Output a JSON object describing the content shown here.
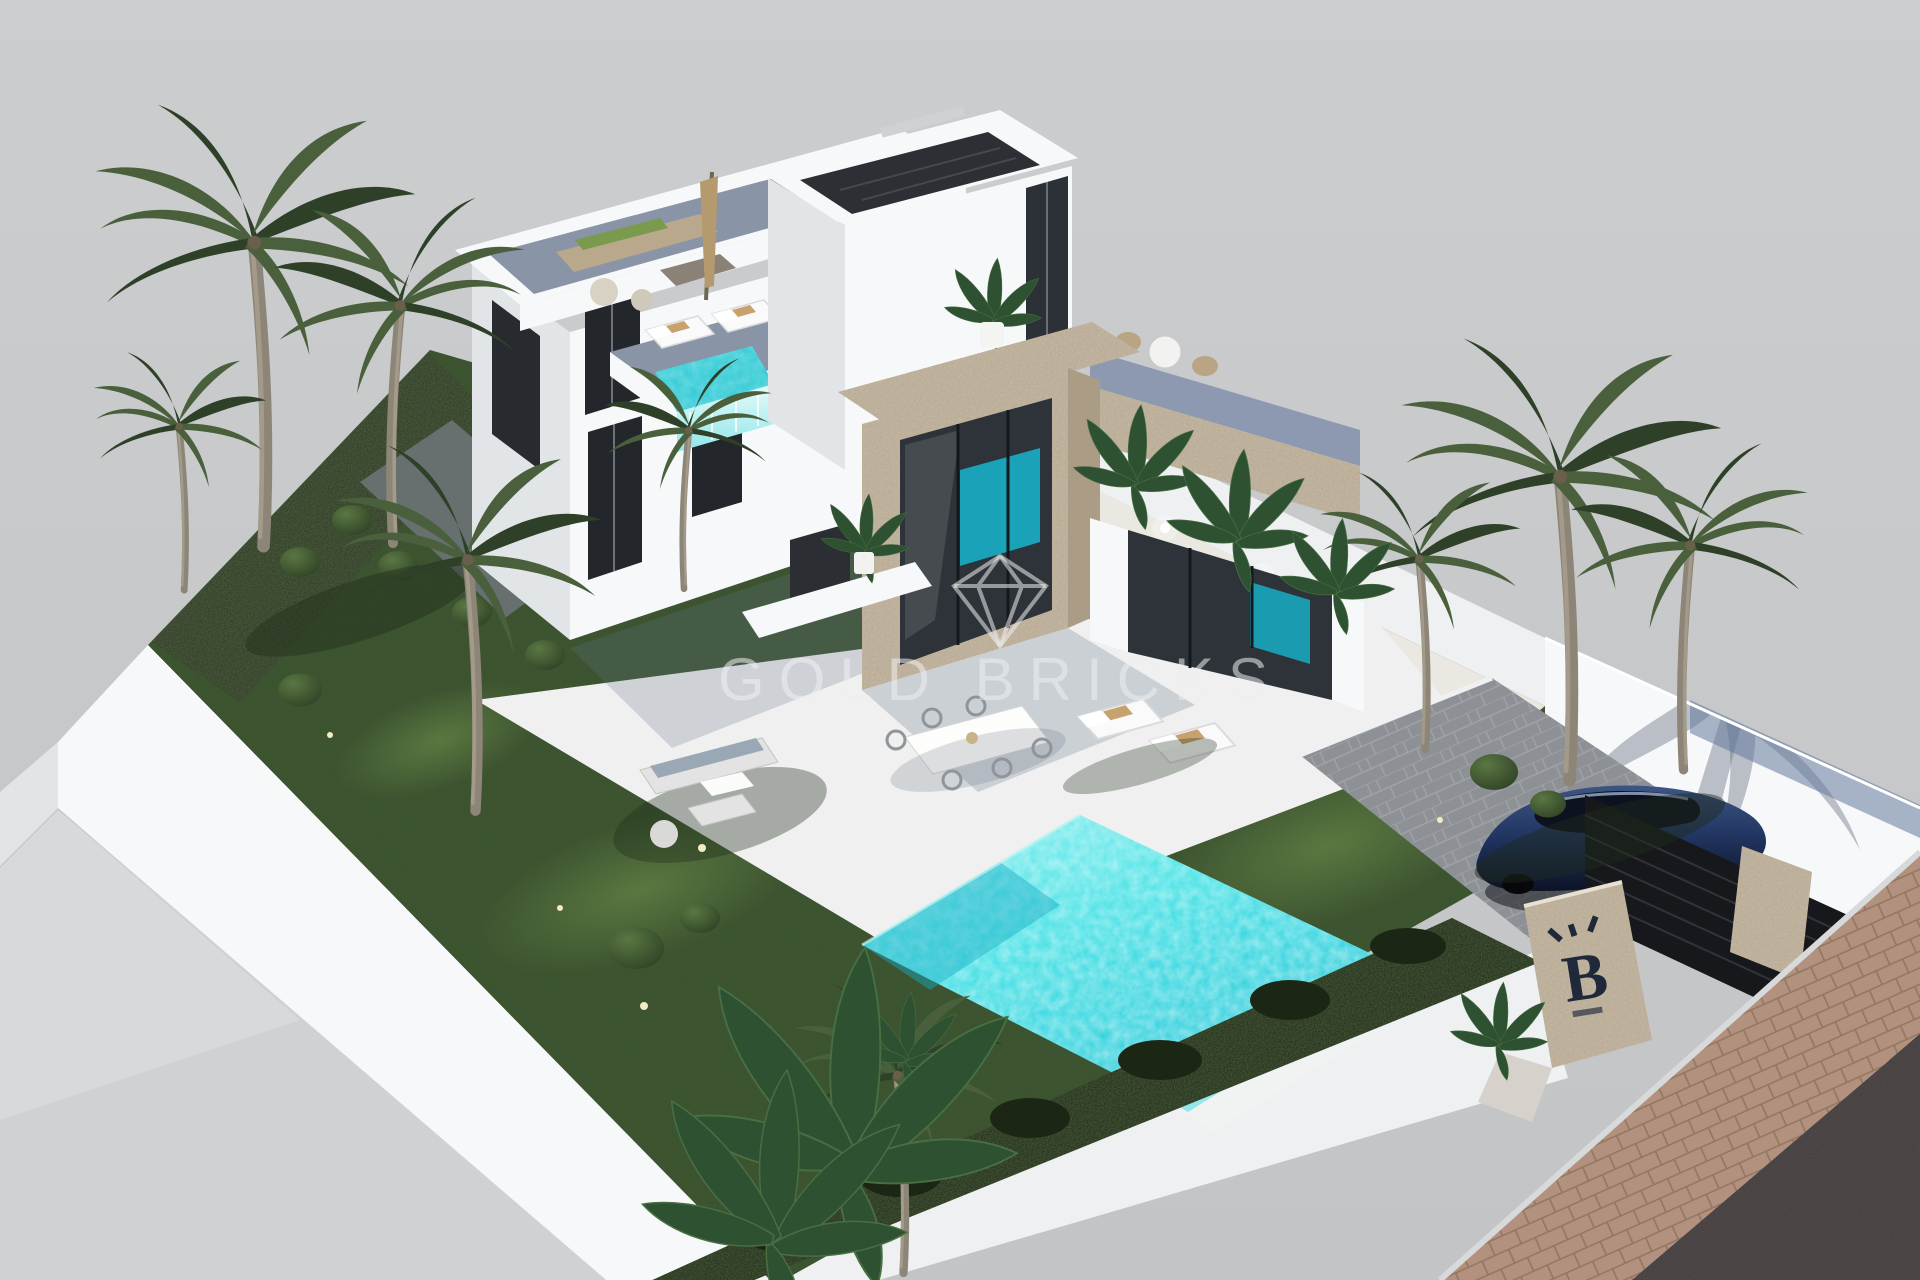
{
  "meta": {
    "kind": "3d-architectural-exterior-render",
    "subject": "modern two-storey villa with garden, swimming pool and carport on an isometric model plot",
    "canvas": {
      "width": 1920,
      "height": 1280
    }
  },
  "watermark": {
    "brand": "GOLD BRICKS",
    "icon": "diamond-outline-icon"
  },
  "gate": {
    "logo_letter": "B"
  },
  "objects": [
    "white-villa",
    "roof-terrace-lounge",
    "closed-parasol",
    "stair-tower",
    "stone-clad-cube",
    "upper-plunge-pool",
    "sun-loungers-upper-terrace",
    "swimming-pool-infinity-edge",
    "lawn",
    "boxwood-hedge",
    "palm-trees",
    "banana-plants",
    "garden-lounge-set",
    "outdoor-dining-set",
    "sun-loungers-garden",
    "driveway",
    "blue-car",
    "black-gate",
    "stone-gate-pillars",
    "perimeter-walls",
    "sidewalk",
    "asphalt-road"
  ],
  "palette": {
    "sky": "#c6c8ca",
    "ground": "#d0d1d3",
    "wall_bright": "#f7f8f9",
    "wall_mid": "#eef0f2",
    "wall_shade": "#e2e5e8",
    "lawn": "#3e5330",
    "lawn_light": "#62804a",
    "bed_dark": "#2b3522",
    "hedge": "#1c2614",
    "terrace": "#eff0ef",
    "deck": "#8a94a7",
    "pool": "#3adfe3",
    "pool_deep": "#17aec6",
    "plunge": "#2cc9d4",
    "stone": "#c8baa5",
    "stone_shade": "#ab9c85",
    "glass_dark": "#2d3338",
    "glass_blue": "#64789c",
    "road": "#544d4e",
    "sidewalk": "#b2917f",
    "sidewalk_line": "#93765f",
    "driveway": "#8d9196",
    "car_body": "#20345f",
    "gate_black": "#17181b",
    "palm": "#4a603c",
    "palm_dark": "#2e4128",
    "trunk": "#8d8577",
    "watermark": "rgba(238,239,240,0.55)",
    "logo": "#20293a"
  }
}
